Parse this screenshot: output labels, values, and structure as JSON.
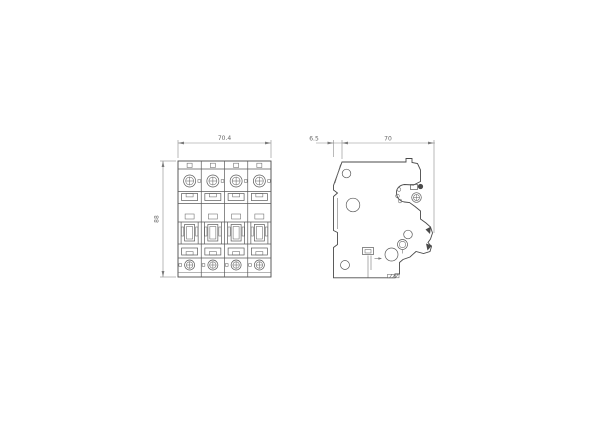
{
  "drawing": {
    "front_view": {
      "width_dim_label": "70.4",
      "height_dim_label": "88",
      "module_count": "4"
    },
    "side_view": {
      "front_offset_dim_label": "6.5",
      "depth_dim_label": "70"
    },
    "colors": {
      "line": "#4a4a4a",
      "dimension_line": "#8c8c8c",
      "dimension_text": "#666666",
      "background": "#ffffff"
    }
  }
}
